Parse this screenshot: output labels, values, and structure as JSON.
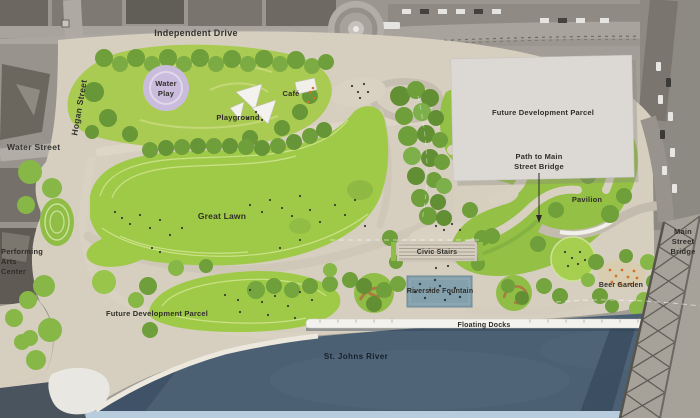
{
  "plan": {
    "streets": {
      "independent_drive": "Independent Drive",
      "hogan_street": "Hogan Street",
      "water_street": "Water Street",
      "main_street_bridge_l1": "Main",
      "main_street_bridge_l2": "Street",
      "main_street_bridge_l3": "Bridge"
    },
    "features": {
      "water_play_l1": "Water",
      "water_play_l2": "Play",
      "cafe": "Café",
      "playground": "Playground",
      "great_lawn": "Great Lawn",
      "future_development_parcel_north": "Future Development Parcel",
      "future_development_parcel_south": "Future Development Parcel",
      "path_to_bridge_l1": "Path to Main",
      "path_to_bridge_l2": "Street Bridge",
      "pavilion": "Pavilion",
      "civic_stairs": "Civic Stairs",
      "riverside_fountain": "Riverside Fountain",
      "beer_garden": "Beer Garden",
      "floating_docks": "Floating Docks",
      "st_johns_river": "St. Johns River",
      "performing_arts_l1": "Performing",
      "performing_arts_l2": "Arts",
      "performing_arts_l3": "Center"
    },
    "colors": {
      "ground_beige": "#d6cfc0",
      "lawn_green": "#9fca48",
      "mound_green": "#a9cb52",
      "tree_green": "#6f9f3b",
      "water_blue": "#4c6073",
      "shore_strip_blue": "#b7cdde",
      "water_play_purple": "#cabcdc",
      "parcel_gray": "#dcd9d5",
      "fountain_blue": "#84a0ad",
      "dock_white": "#f4f2ee",
      "bridge_gray": "#a6a29a",
      "chair_orange": "#d4722a"
    }
  }
}
